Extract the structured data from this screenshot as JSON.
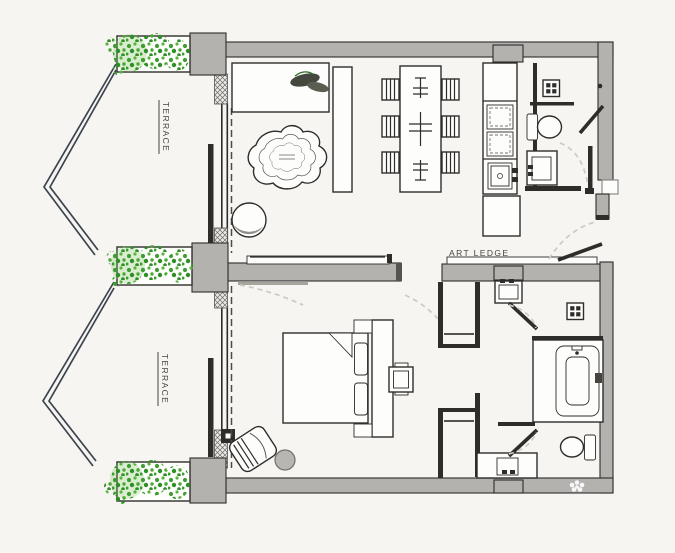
{
  "labels": {
    "terrace_upper": "TERRACE",
    "terrace_lower": "TERRACE",
    "art_ledge": "ART LEDGE"
  },
  "icons": {
    "shaft_upper": "shaft-grid-icon",
    "shaft_lower": "shaft-grid-icon",
    "watermark": "flower-watermark-icon"
  },
  "colors": {
    "paper": "#f6f5f2",
    "wall": "#b3b2af",
    "line": "#2e2d2a",
    "railing": "#3d4450",
    "foliage_dark": "#2e8f26",
    "foliage_mid": "#3f9d33",
    "foliage_light": "#59b43c"
  }
}
